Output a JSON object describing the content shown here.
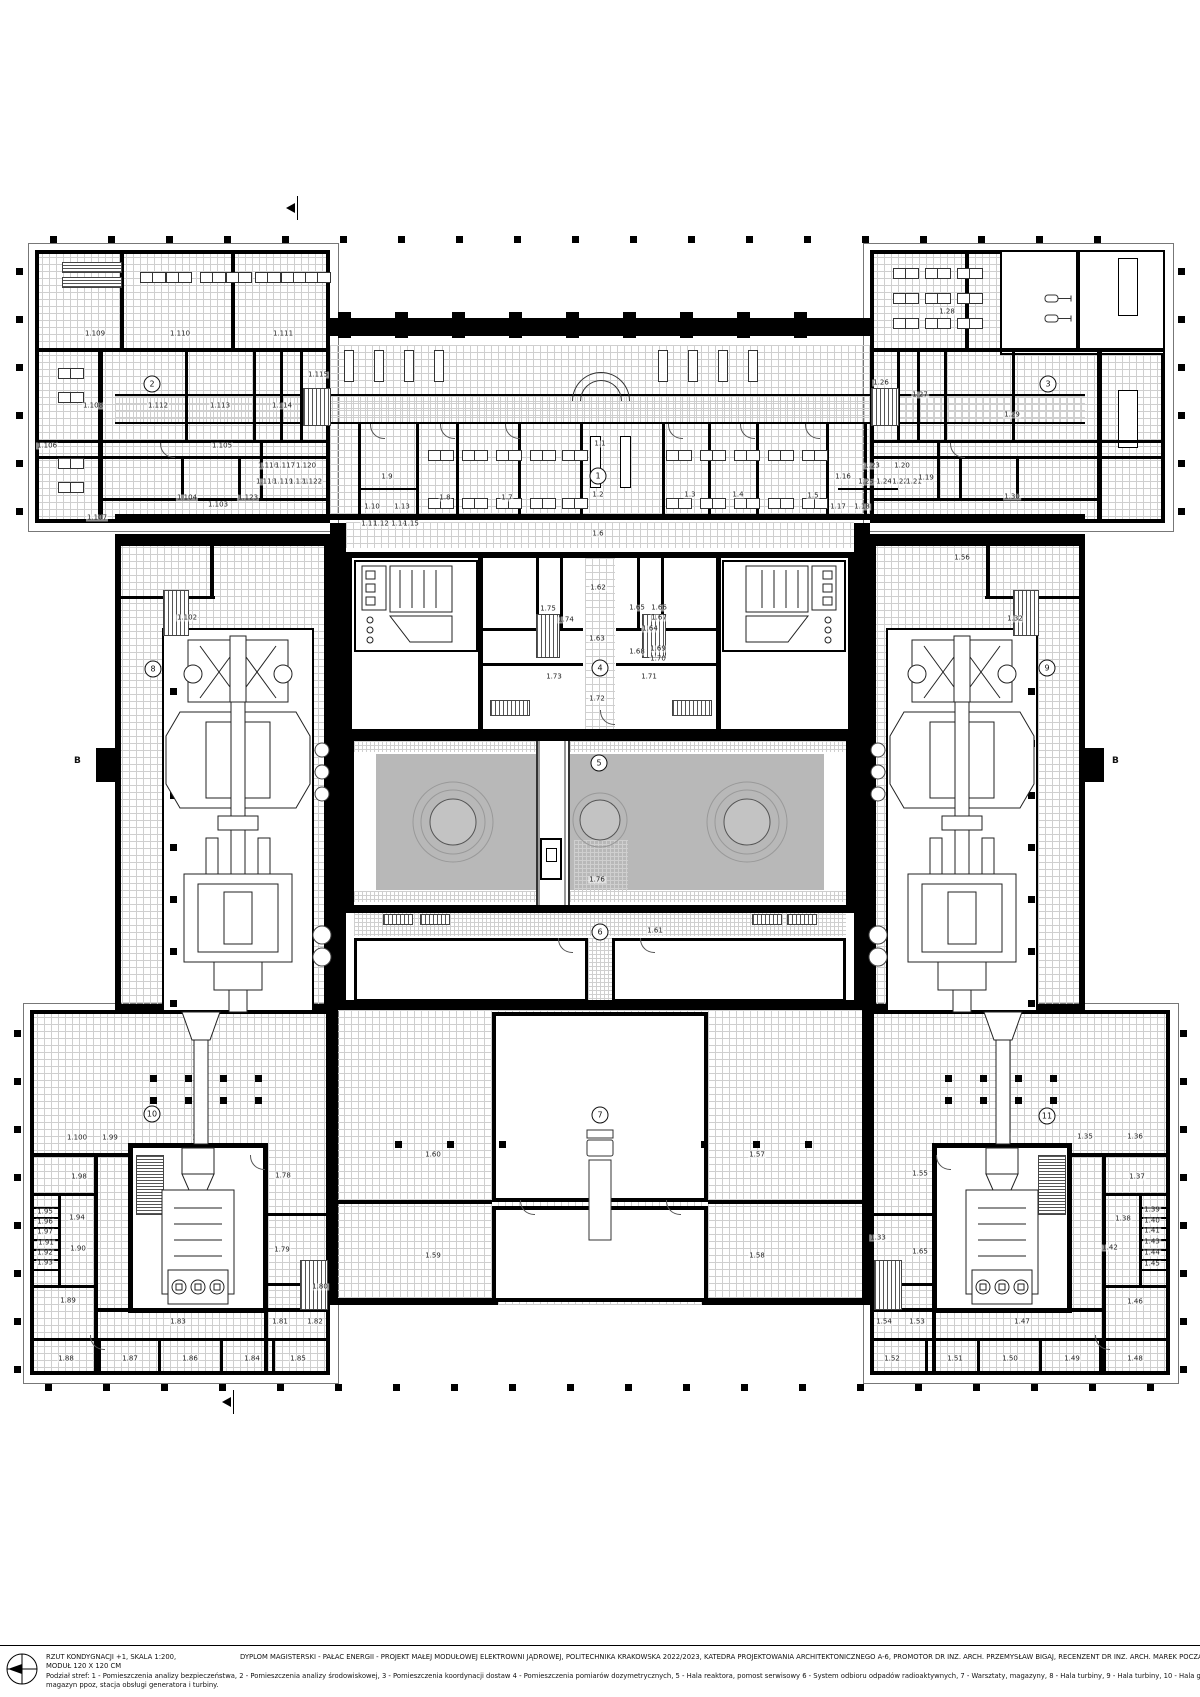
{
  "title_block": {
    "scale_note": "RZUT KONDYGNACJI +1, SKALA 1:200,",
    "module_note": "MODUŁ 120 X 120 CM",
    "project_line": "DYPLOM MAGISTERSKI - PAŁAC ENERGII - PROJEKT MAŁEJ MODUŁOWEJ ELEKTROWNI JĄDROWEJ, POLITECHNIKA KRAKOWSKA  2022/2023, KATEDRA PROJEKTOWANIA ARCHITEKTONICZNEGO A-6, PROMOTOR DR INZ. ARCH. PRZEMYSŁAW BIGAJ, RECENZENT DR INZ. ARCH. MAREK POCZĄTKO,  AUTOR INZ. ARCH. IZABELA SIWIŃSKA",
    "legend_line1": "Podział stref:    1  - Pomieszczenia analizy bezpieczeństwa,   2  - Pomieszczenia analizy środowiskowej,   3  - Pomieszczenia koordynacji dostaw   4  - Pomieszczenia pomiarów dozymetrycznych,   5  - Hala reaktora, pomost serwisowy   6  - System odbioru odpadów radioaktywnych,   7  - Warsztaty, magazyny,  8 - Hala turbiny,   9  - Hala turbiny, 10 - Hala generatora, magazyn ppoz, stacja obsługi generatora i turbiny, 11 - Hala generatora,",
    "legend_line2": "magazyn ppoz, stacja obsługi generatora i turbiny."
  },
  "section_markers": {
    "left": "B",
    "right": "B"
  },
  "zones": [
    [
      "1",
      598,
      476
    ],
    [
      "2",
      152,
      384
    ],
    [
      "3",
      1048,
      384
    ],
    [
      "4",
      600,
      668
    ],
    [
      "5",
      599,
      763
    ],
    [
      "6",
      600,
      932
    ],
    [
      "7",
      600,
      1115
    ],
    [
      "8",
      153,
      669
    ],
    [
      "9",
      1047,
      668
    ],
    [
      "10",
      152,
      1114
    ],
    [
      "11",
      1047,
      1116
    ]
  ],
  "rooms": [
    [
      "1.109",
      95,
      334
    ],
    [
      "1.110",
      180,
      334
    ],
    [
      "1.111",
      283,
      334
    ],
    [
      "1.108",
      93,
      406
    ],
    [
      "1.112",
      158,
      406
    ],
    [
      "1.113",
      220,
      406
    ],
    [
      "1.114",
      282,
      406
    ],
    [
      "1.115",
      318,
      375
    ],
    [
      "1.106",
      47,
      446
    ],
    [
      "1.105",
      222,
      446
    ],
    [
      "1.104",
      187,
      498
    ],
    [
      "1.123",
      248,
      498
    ],
    [
      "1.107",
      97,
      518
    ],
    [
      "1.116",
      268,
      466
    ],
    [
      "1.117",
      285,
      466
    ],
    [
      "1.120",
      306,
      466
    ],
    [
      "1.118",
      266,
      482
    ],
    [
      "1.119",
      283,
      482
    ],
    [
      "1.121",
      299,
      482
    ],
    [
      "1.122",
      312,
      482
    ],
    [
      "1.103",
      218,
      505
    ],
    [
      "1.1",
      600,
      444
    ],
    [
      "1.9",
      387,
      477
    ],
    [
      "1.10",
      372,
      507
    ],
    [
      "1.13",
      402,
      507
    ],
    [
      "1.11",
      369,
      524
    ],
    [
      "1.12",
      381,
      524
    ],
    [
      "1.14",
      399,
      524
    ],
    [
      "1.15",
      411,
      524
    ],
    [
      "1.8",
      445,
      498
    ],
    [
      "1.7",
      507,
      498
    ],
    [
      "1.2",
      598,
      495
    ],
    [
      "1.3",
      690,
      495
    ],
    [
      "1.4",
      738,
      495
    ],
    [
      "1.5",
      813,
      496
    ],
    [
      "1.16",
      843,
      477
    ],
    [
      "1.17",
      838,
      507
    ],
    [
      "1.18",
      862,
      507
    ],
    [
      "1.6",
      598,
      534
    ],
    [
      "1.28",
      947,
      312
    ],
    [
      "1.26",
      881,
      383
    ],
    [
      "1.27",
      920,
      395
    ],
    [
      "1.29",
      1012,
      415
    ],
    [
      "1.23",
      872,
      466
    ],
    [
      "1.20",
      902,
      466
    ],
    [
      "1.25",
      866,
      482
    ],
    [
      "1.24",
      884,
      482
    ],
    [
      "1.22",
      900,
      482
    ],
    [
      "1.21",
      914,
      482
    ],
    [
      "1.19",
      926,
      478
    ],
    [
      "1.30",
      1012,
      497
    ],
    [
      "1.56",
      962,
      558
    ],
    [
      "1.102",
      187,
      618
    ],
    [
      "1.101",
      262,
      660
    ],
    [
      "1.32",
      1015,
      619
    ],
    [
      "1.31",
      933,
      658
    ],
    [
      "1.62",
      598,
      588
    ],
    [
      "1.75",
      548,
      609
    ],
    [
      "1.74",
      566,
      620
    ],
    [
      "1.63",
      597,
      639
    ],
    [
      "1.65",
      637,
      608
    ],
    [
      "1.66",
      659,
      608
    ],
    [
      "1.67",
      659,
      618
    ],
    [
      "1.64",
      650,
      629
    ],
    [
      "1.68",
      637,
      652
    ],
    [
      "1.69",
      658,
      649
    ],
    [
      "1.70",
      658,
      659
    ],
    [
      "1.73",
      554,
      677
    ],
    [
      "1.71",
      649,
      677
    ],
    [
      "1.72",
      597,
      699
    ],
    [
      "1.76",
      597,
      880
    ],
    [
      "1.61",
      655,
      931
    ],
    [
      "1.60",
      433,
      1155
    ],
    [
      "1.57",
      757,
      1155
    ],
    [
      "1.59",
      433,
      1256
    ],
    [
      "1.58",
      757,
      1256
    ],
    [
      "1.100",
      77,
      1138
    ],
    [
      "1.99",
      110,
      1138
    ],
    [
      "1.77",
      200,
      1138
    ],
    [
      "1.98",
      79,
      1177
    ],
    [
      "1.78",
      283,
      1176
    ],
    [
      "1.95",
      45,
      1212
    ],
    [
      "1.96",
      45,
      1222
    ],
    [
      "1.97",
      45,
      1232
    ],
    [
      "1.94",
      77,
      1218
    ],
    [
      "1.91",
      46,
      1243
    ],
    [
      "1.92",
      45,
      1253
    ],
    [
      "1.93",
      45,
      1263
    ],
    [
      "1.90",
      78,
      1249
    ],
    [
      "1.79",
      282,
      1250
    ],
    [
      "1.89",
      68,
      1301
    ],
    [
      "1.80",
      320,
      1287
    ],
    [
      "1.83",
      178,
      1322
    ],
    [
      "1.81",
      280,
      1322
    ],
    [
      "1.82",
      315,
      1322
    ],
    [
      "1.88",
      66,
      1359
    ],
    [
      "1.87",
      130,
      1359
    ],
    [
      "1.86",
      190,
      1359
    ],
    [
      "1.84",
      252,
      1359
    ],
    [
      "1.85",
      298,
      1359
    ],
    [
      "1.34",
      1003,
      1136
    ],
    [
      "1.35",
      1085,
      1137
    ],
    [
      "1.36",
      1135,
      1137
    ],
    [
      "1.55",
      920,
      1174
    ],
    [
      "1.37",
      1137,
      1177
    ],
    [
      "1.38",
      1123,
      1219
    ],
    [
      "1.39",
      1152,
      1210
    ],
    [
      "1.40",
      1152,
      1221
    ],
    [
      "1.41",
      1152,
      1231
    ],
    [
      "1.42",
      1110,
      1248
    ],
    [
      "1.43",
      1152,
      1242
    ],
    [
      "1.44",
      1152,
      1253
    ],
    [
      "1.45",
      1152,
      1264
    ],
    [
      "1.33",
      878,
      1238
    ],
    [
      "1.65",
      920,
      1252
    ],
    [
      "1.46",
      1135,
      1302
    ],
    [
      "1.54",
      884,
      1322
    ],
    [
      "1.53",
      917,
      1322
    ],
    [
      "1.47",
      1022,
      1322
    ],
    [
      "1.52",
      892,
      1359
    ],
    [
      "1.51",
      955,
      1359
    ],
    [
      "1.50",
      1010,
      1359
    ],
    [
      "1.49",
      1072,
      1359
    ],
    [
      "1.48",
      1135,
      1359
    ]
  ]
}
